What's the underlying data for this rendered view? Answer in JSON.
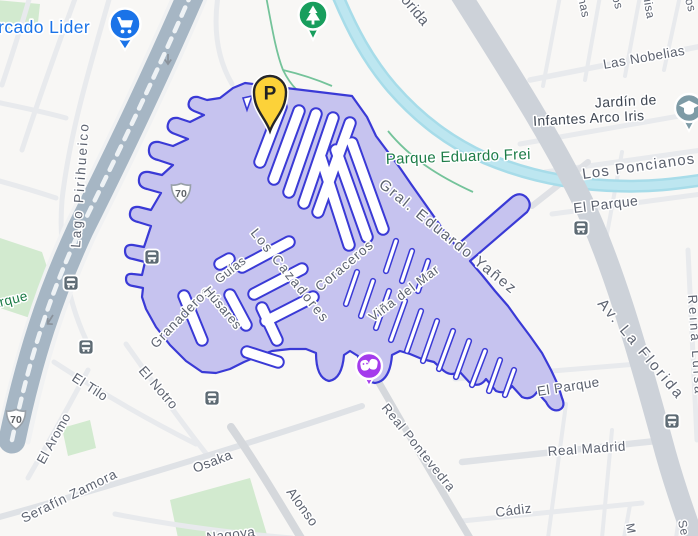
{
  "map": {
    "labels": {
      "mercado_lider": "Mercado Lider",
      "florida_top": "Florida",
      "las_nobelias": "Las Nobelias",
      "jardin_1": "Jardín de",
      "jardin_2": "Infantes Arco Iris",
      "frag_nas": "nas",
      "frag_os": "os",
      "frag_uisa": "uisa",
      "frag_tos": "tos",
      "parque_eduardo_frei": "Parque Eduardo Frei",
      "los_poncianos": "Los Poncianos",
      "el_parque_ne": "El Parque",
      "lago_pirihueico": "Lago Pirihueico",
      "parque_west": "Parque",
      "granaderos": "Granaderos",
      "guias": "Guías",
      "los_cazadores": "Los Cazadores",
      "husares": "Húsares",
      "coraceros": "Coraceros",
      "gral_eduardo_yanez": "Gral. Eduardo Yañez",
      "vina_del_mar": "Viña del Mar",
      "av_la_florida": "Av. La Florida",
      "reina_luisa": "Reina Luisa",
      "el_tilo": "El Tilo",
      "el_notro": "El Notro",
      "el_aromo": "El Aromo",
      "serafin_zamora": "Serafín Zamora",
      "osaka": "Osaka",
      "nagoya": "Nagoya",
      "alonso": "Alonso",
      "real_pontevedra": "Real Pontevedra",
      "real_madrid": "Real Madrid",
      "cadiz": "Cádiz",
      "el_parque_se": "El Parque",
      "frag_m": "M",
      "frag_se": "Se",
      "shield_route": "70",
      "parking_letter": "P"
    },
    "icons": {
      "supermarket_pin": "shopping-cart-icon",
      "park_pin": "tree-icon",
      "parking_pin": "parking-icon",
      "theater_pin": "theater-masks-icon",
      "school_pin": "graduation-cap-icon",
      "bus_stop": "bus-icon",
      "route_shield": "highway-shield-icon",
      "one_way": "one-way-arrow-icon"
    },
    "colors": {
      "selection_fill": "#c6c3ef",
      "selection_stroke": "#3a3ad6",
      "water": "#a7dce9",
      "park_green": "#d2eacf",
      "road_major": "#cdd2d9",
      "highway": "#a6b6c4",
      "poi_blue": "#1a73e8",
      "park_text": "#1c7c47",
      "street_text": "#5d6370",
      "parking_yellow": "#fcd239",
      "theater_purple": "#a43bec",
      "school_teal": "#7e9ba6",
      "bus_gray": "#5d6a73"
    }
  }
}
